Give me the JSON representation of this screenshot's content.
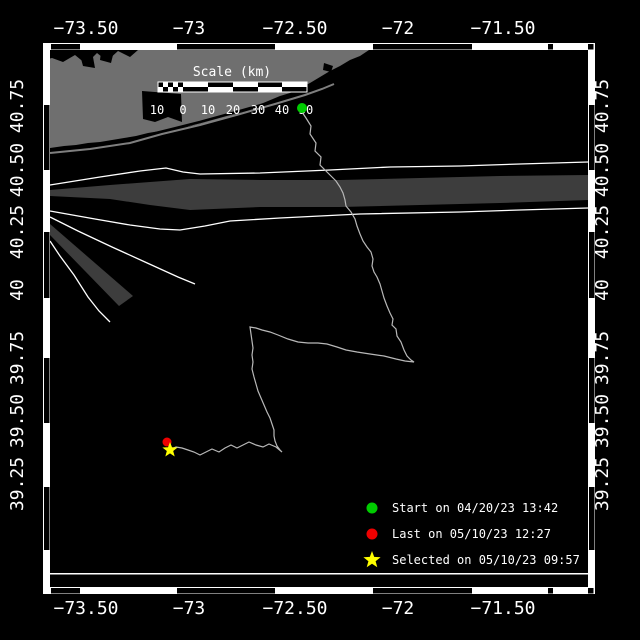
{
  "colors": {
    "background": "#000000",
    "land": "#6f6f6f",
    "coast_line": "#7f7f7f",
    "separation_zone": "#3d3d3d",
    "lane_line": "#ffffff",
    "track": "#b8b8b8",
    "frame": "#ffffff",
    "text": "#ffffff",
    "start": "#00cc00",
    "last": "#ee0000",
    "selected": "#ffff00"
  },
  "axes": {
    "x_labels": [
      {
        "text": "−73.50",
        "x": 86
      },
      {
        "text": "−73",
        "x": 189
      },
      {
        "text": "−72.50",
        "x": 295
      },
      {
        "text": "−72",
        "x": 398
      },
      {
        "text": "−71.50",
        "x": 503
      }
    ],
    "x_top_y": 28,
    "x_bottom_y": 608,
    "y_labels": [
      {
        "text": "40.75",
        "y": 106
      },
      {
        "text": "40.50",
        "y": 170
      },
      {
        "text": "40.25",
        "y": 232
      },
      {
        "text": "40",
        "y": 290
      },
      {
        "text": "39.75",
        "y": 358
      },
      {
        "text": "39.50",
        "y": 421
      },
      {
        "text": "39.25",
        "y": 484
      }
    ],
    "y_left_x": 23,
    "y_right_x": 608
  },
  "frame": {
    "band_rects": [
      {
        "x": 43,
        "y": 43,
        "w": 552,
        "h": 7
      },
      {
        "x": 43,
        "y": 587,
        "w": 552,
        "h": 7
      },
      {
        "x": 43,
        "y": 43,
        "w": 7,
        "h": 551
      },
      {
        "x": 588,
        "y": 43,
        "w": 7,
        "h": 551
      }
    ],
    "zebra_x": [
      [
        51,
        80
      ],
      [
        177,
        275
      ],
      [
        373,
        472
      ],
      [
        548,
        553
      ]
    ],
    "zebra_y": [
      [
        105,
        170
      ],
      [
        232,
        298
      ],
      [
        358,
        423
      ],
      [
        487,
        550
      ]
    ],
    "corner_squares": [
      [
        588,
        44
      ],
      [
        588,
        588
      ]
    ],
    "inner_line": {
      "x": 50,
      "y": 573,
      "w": 538,
      "h": 1.5
    }
  },
  "scale_bar": {
    "title": "Scale (km)",
    "title_x": 232,
    "title_y": 76,
    "bar": {
      "x": 158,
      "y": 82,
      "w": 149,
      "h": 10
    },
    "cells": [
      158,
      183,
      208,
      233,
      258,
      282,
      307
    ],
    "checker_cols": 5,
    "labels": [
      {
        "text": "10",
        "x": 157
      },
      {
        "text": "0",
        "x": 183
      },
      {
        "text": "10",
        "x": 208
      },
      {
        "text": "20",
        "x": 233
      },
      {
        "text": "30",
        "x": 258
      },
      {
        "text": "40",
        "x": 282
      },
      {
        "text": "50",
        "x": 306
      }
    ],
    "labels_y": 114
  },
  "legend": {
    "marker_x": 372,
    "text_x": 392,
    "items": [
      {
        "marker": "dot",
        "color": "#00cc00",
        "label": "Start on 04/20/23 13:42",
        "y": 508
      },
      {
        "marker": "dot",
        "color": "#ee0000",
        "label": "Last on 05/10/23 12:27",
        "y": 534
      },
      {
        "marker": "star",
        "color": "#ffff00",
        "label": "Selected on 05/10/23 09:57",
        "y": 560
      }
    ]
  },
  "geo": {
    "land": [
      [
        44,
        44
      ],
      [
        372,
        44
      ],
      [
        372,
        48
      ],
      [
        360,
        56
      ],
      [
        350,
        60
      ],
      [
        340,
        66
      ],
      [
        330,
        71
      ],
      [
        320,
        77
      ],
      [
        310,
        83
      ],
      [
        300,
        88
      ],
      [
        290,
        93
      ],
      [
        280,
        96
      ],
      [
        268,
        101
      ],
      [
        256,
        106
      ],
      [
        244,
        111
      ],
      [
        232,
        115
      ],
      [
        220,
        119
      ],
      [
        208,
        122
      ],
      [
        196,
        125
      ],
      [
        184,
        127
      ],
      [
        172,
        129
      ],
      [
        160,
        131
      ],
      [
        148,
        133
      ],
      [
        136,
        136
      ],
      [
        124,
        138
      ],
      [
        112,
        140
      ],
      [
        100,
        142
      ],
      [
        88,
        143
      ],
      [
        76,
        145
      ],
      [
        64,
        146
      ],
      [
        50,
        148
      ],
      [
        44,
        149
      ]
    ],
    "north_shore_water": [
      [
        44,
        44
      ],
      [
        138,
        44
      ],
      [
        138,
        50
      ],
      [
        130,
        57
      ],
      [
        118,
        51
      ],
      [
        107,
        61
      ],
      [
        97,
        53
      ],
      [
        86,
        64
      ],
      [
        75,
        55
      ],
      [
        63,
        62
      ],
      [
        52,
        58
      ],
      [
        44,
        60
      ]
    ],
    "ponds": [
      [
        [
          80,
          55
        ],
        [
          93,
          57
        ],
        [
          95,
          68
        ],
        [
          83,
          66
        ]
      ],
      [
        [
          101,
          52
        ],
        [
          113,
          55
        ],
        [
          111,
          63
        ],
        [
          100,
          60
        ]
      ],
      [
        [
          324,
          63
        ],
        [
          333,
          66
        ],
        [
          331,
          72
        ],
        [
          323,
          70
        ]
      ]
    ],
    "bay_notch": [
      [
        142,
        91
      ],
      [
        181,
        94
      ],
      [
        182,
        122
      ],
      [
        168,
        117
      ],
      [
        155,
        122
      ],
      [
        143,
        119
      ]
    ],
    "bay_line": [
      [
        50,
        150
      ],
      [
        90,
        146
      ],
      [
        130,
        140
      ],
      [
        160,
        132
      ],
      [
        200,
        122
      ],
      [
        240,
        111
      ],
      [
        275,
        101
      ],
      [
        300,
        92
      ]
    ],
    "barrier_line": [
      [
        50,
        153
      ],
      [
        90,
        149
      ],
      [
        130,
        143
      ],
      [
        162,
        134
      ],
      [
        200,
        125
      ],
      [
        240,
        114
      ],
      [
        275,
        104
      ],
      [
        305,
        95
      ],
      [
        322,
        89
      ],
      [
        334,
        84
      ]
    ],
    "lanes": {
      "upper_line": [
        [
          50,
          185
        ],
        [
          100,
          177
        ],
        [
          140,
          171
        ],
        [
          166,
          168
        ],
        [
          183,
          172
        ],
        [
          200,
          174
        ],
        [
          260,
          173
        ],
        [
          330,
          170
        ],
        [
          390,
          167
        ],
        [
          460,
          166
        ],
        [
          520,
          164
        ],
        [
          588,
          162
        ]
      ],
      "separation_zone": [
        [
          50,
          190
        ],
        [
          110,
          185
        ],
        [
          150,
          182
        ],
        [
          190,
          179
        ],
        [
          260,
          180
        ],
        [
          340,
          180
        ],
        [
          420,
          178
        ],
        [
          500,
          176
        ],
        [
          588,
          175
        ],
        [
          588,
          200
        ],
        [
          500,
          203
        ],
        [
          420,
          205
        ],
        [
          340,
          207
        ],
        [
          260,
          207
        ],
        [
          190,
          210
        ],
        [
          150,
          205
        ],
        [
          110,
          199
        ],
        [
          50,
          196
        ]
      ],
      "lower_line": [
        [
          50,
          211
        ],
        [
          95,
          219
        ],
        [
          130,
          225
        ],
        [
          160,
          229
        ],
        [
          180,
          230
        ],
        [
          205,
          226
        ],
        [
          230,
          221
        ],
        [
          280,
          218
        ],
        [
          360,
          214
        ],
        [
          460,
          212
        ],
        [
          520,
          210
        ],
        [
          588,
          208
        ]
      ],
      "fan_line_1": [
        [
          50,
          217
        ],
        [
          78,
          231
        ],
        [
          112,
          247
        ],
        [
          145,
          262
        ],
        [
          178,
          277
        ],
        [
          195,
          284
        ]
      ],
      "wedge": [
        [
          50,
          224
        ],
        [
          50,
          235
        ],
        [
          119,
          306
        ],
        [
          133,
          296
        ]
      ],
      "fan_line_2": [
        [
          50,
          241
        ],
        [
          60,
          256
        ],
        [
          74,
          275
        ],
        [
          88,
          297
        ],
        [
          99,
          311
        ],
        [
          110,
          322
        ]
      ]
    }
  },
  "track": {
    "points": [
      [
        302,
        112
      ],
      [
        306,
        118
      ],
      [
        311,
        126
      ],
      [
        310,
        134
      ],
      [
        316,
        143
      ],
      [
        315,
        151
      ],
      [
        321,
        157
      ],
      [
        320,
        165
      ],
      [
        326,
        171
      ],
      [
        331,
        176
      ],
      [
        336,
        181
      ],
      [
        340,
        187
      ],
      [
        343,
        193
      ],
      [
        345,
        200
      ],
      [
        346,
        206
      ],
      [
        351,
        212
      ],
      [
        355,
        219
      ],
      [
        357,
        226
      ],
      [
        360,
        234
      ],
      [
        363,
        241
      ],
      [
        367,
        247
      ],
      [
        371,
        252
      ],
      [
        373,
        259
      ],
      [
        372,
        266
      ],
      [
        374,
        272
      ],
      [
        377,
        277
      ],
      [
        380,
        284
      ],
      [
        382,
        291
      ],
      [
        384,
        298
      ],
      [
        387,
        306
      ],
      [
        390,
        313
      ],
      [
        393,
        319
      ],
      [
        392,
        325
      ],
      [
        396,
        329
      ],
      [
        397,
        336
      ],
      [
        401,
        342
      ],
      [
        404,
        350
      ],
      [
        407,
        356
      ],
      [
        411,
        360
      ],
      [
        414,
        362
      ],
      [
        405,
        361
      ],
      [
        396,
        359
      ],
      [
        384,
        356
      ],
      [
        370,
        354
      ],
      [
        357,
        352
      ],
      [
        346,
        350
      ],
      [
        337,
        347
      ],
      [
        327,
        344
      ],
      [
        318,
        343
      ],
      [
        308,
        343
      ],
      [
        298,
        342
      ],
      [
        288,
        339
      ],
      [
        278,
        335
      ],
      [
        270,
        332
      ],
      [
        262,
        330
      ],
      [
        256,
        328
      ],
      [
        250,
        327
      ],
      [
        251,
        334
      ],
      [
        252,
        341
      ],
      [
        253,
        348
      ],
      [
        252,
        355
      ],
      [
        253,
        362
      ],
      [
        252,
        369
      ],
      [
        254,
        377
      ],
      [
        256,
        384
      ],
      [
        258,
        391
      ],
      [
        261,
        398
      ],
      [
        264,
        405
      ],
      [
        267,
        412
      ],
      [
        270,
        418
      ],
      [
        272,
        424
      ],
      [
        274,
        430
      ],
      [
        274,
        436
      ],
      [
        275,
        441
      ],
      [
        277,
        446
      ],
      [
        280,
        450
      ],
      [
        282,
        452
      ],
      [
        276,
        447
      ],
      [
        269,
        444
      ],
      [
        263,
        447
      ],
      [
        256,
        445
      ],
      [
        249,
        442
      ],
      [
        243,
        445
      ],
      [
        237,
        448
      ],
      [
        231,
        445
      ],
      [
        225,
        448
      ],
      [
        219,
        452
      ],
      [
        212,
        449
      ],
      [
        206,
        452
      ],
      [
        200,
        455
      ],
      [
        194,
        452
      ],
      [
        188,
        450
      ],
      [
        182,
        448
      ],
      [
        176,
        447
      ],
      [
        171,
        449
      ]
    ],
    "start_marker": {
      "x": 302,
      "y": 108,
      "r": 5
    },
    "last_marker": {
      "x": 167,
      "y": 442,
      "r": 4.5
    },
    "selected_marker": {
      "x": 170,
      "y": 450,
      "r": 8
    }
  }
}
